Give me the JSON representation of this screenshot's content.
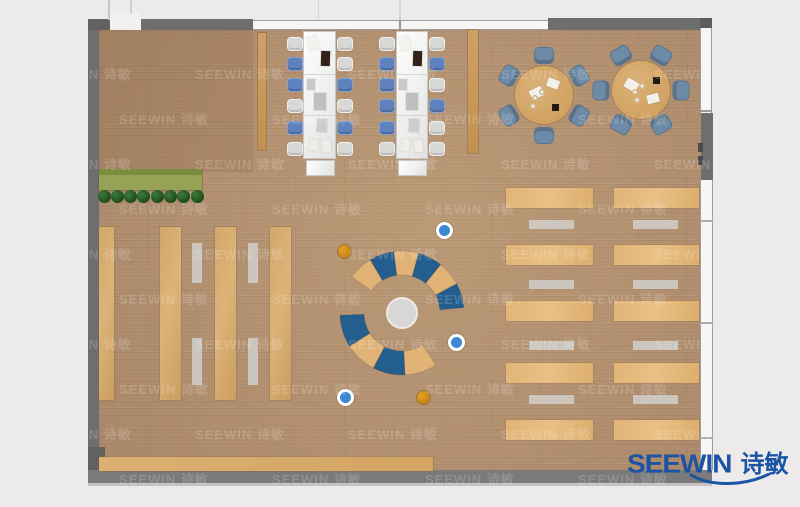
{
  "colors": {
    "outside": "#edebe9",
    "wall_dark": "#6e6e6e",
    "wall_bottom": "#7a7a7a",
    "floor_wood": "#b29070",
    "desk_tan": "#e0b273",
    "shelf_tan": "#d2a76a",
    "arc_blue": "#235e8f",
    "arc_tan": "#e2b377",
    "chair_blue": "#5d82bd",
    "chair_gray": "#d7d8d6",
    "round_chair_slate": "#6d8ba6",
    "stool_orange": "#cf8c15",
    "stool_blue": "#3d87d3",
    "logo_blue": "#1b53a6"
  },
  "logo": {
    "brand": "SEEWIN",
    "cjk": "诗敏",
    "color": "#1b53a6"
  },
  "watermark": {
    "text": "SEEWIN 诗敏",
    "opacity": 0.17,
    "font_size": 13,
    "area": {
      "x": 82,
      "y": 16,
      "w": 634,
      "h": 468
    },
    "row0": 48,
    "row_step": 45,
    "row_count": 10,
    "col0": -40,
    "col_step": 153,
    "odd_row_offset": 77
  },
  "room": {
    "floor": {
      "x": 99,
      "y": 29,
      "w": 602,
      "h": 442
    },
    "lounge_patch": {
      "x": 99,
      "y": 29,
      "w": 154,
      "h": 143,
      "color": "rgba(96,64,32,0.12)"
    }
  },
  "walls": [
    {
      "name": "wall-left",
      "x": 88,
      "y": 19,
      "w": 11,
      "h": 448,
      "color": "#6e6e6e"
    },
    {
      "name": "wall-top-left-corner",
      "x": 88,
      "y": 19,
      "w": 22,
      "h": 11,
      "color": "#626262"
    },
    {
      "name": "wall-top-segment-left",
      "x": 141,
      "y": 19,
      "w": 112,
      "h": 11,
      "color": "#6e6e6e"
    },
    {
      "name": "wall-top-segment-right",
      "x": 548,
      "y": 18,
      "w": 164,
      "h": 12,
      "color": "#6e6e6e"
    },
    {
      "name": "wall-top-right-cap",
      "x": 700,
      "y": 18,
      "w": 12,
      "h": 12,
      "color": "#5d5d5d"
    },
    {
      "name": "wall-right-solid",
      "x": 701,
      "y": 113,
      "w": 12,
      "h": 67,
      "color": "#6e6e6e"
    },
    {
      "name": "wall-bottom",
      "x": 88,
      "y": 470,
      "w": 624,
      "h": 13,
      "color": "#7a7a7a"
    },
    {
      "name": "wall-bottom-left-corner",
      "x": 88,
      "y": 447,
      "w": 17,
      "h": 23,
      "color": "#616161"
    }
  ],
  "windows": [
    {
      "name": "window-top",
      "x": 253,
      "y": 20,
      "w": 295,
      "h": 10,
      "orient": "h"
    },
    {
      "name": "window-right-upper",
      "x": 700,
      "y": 28,
      "w": 12,
      "h": 85,
      "orient": "v"
    },
    {
      "name": "window-right-lower",
      "x": 700,
      "y": 180,
      "w": 13,
      "h": 290,
      "orient": "v"
    },
    {
      "name": "door-opening-top",
      "x": 110,
      "y": 13,
      "w": 31,
      "h": 17,
      "orient": "open"
    }
  ],
  "lines": [
    {
      "name": "ceiling-line-1",
      "x": 108,
      "y": 0,
      "w": 2,
      "h": 20,
      "color": "#c7c5c2"
    },
    {
      "name": "ceiling-line-2",
      "x": 130,
      "y": 0,
      "w": 2,
      "h": 14,
      "color": "#d2d0cd"
    },
    {
      "name": "ceiling-line-3",
      "x": 318,
      "y": 0,
      "w": 1,
      "h": 20,
      "color": "#d8d6d3"
    },
    {
      "name": "window-mullion-upper",
      "x": 399,
      "y": 0,
      "w": 2,
      "h": 20,
      "color": "#d8d6d3"
    },
    {
      "name": "window-mullion",
      "x": 399,
      "y": 20,
      "w": 2,
      "h": 10,
      "color": "#9a9a9a"
    },
    {
      "name": "right-wall-tick-1",
      "x": 700,
      "y": 110,
      "w": 12,
      "h": 2,
      "color": "#9a9a9a"
    },
    {
      "name": "right-wall-tick-2",
      "x": 700,
      "y": 220,
      "w": 13,
      "h": 2,
      "color": "#ababab"
    },
    {
      "name": "right-wall-tick-3",
      "x": 700,
      "y": 322,
      "w": 13,
      "h": 2,
      "color": "#ababab"
    },
    {
      "name": "right-wall-tick-4",
      "x": 700,
      "y": 437,
      "w": 13,
      "h": 2,
      "color": "#ababab"
    },
    {
      "name": "right-door-handle-1",
      "x": 698,
      "y": 143,
      "w": 5,
      "h": 9,
      "color": "#4a4a4a"
    },
    {
      "name": "right-door-handle-2",
      "x": 698,
      "y": 156,
      "w": 5,
      "h": 9,
      "color": "#4a4a4a"
    },
    {
      "name": "bottom-wall-shadow",
      "x": 88,
      "y": 483,
      "w": 624,
      "h": 3,
      "color": "#c5c3c0"
    }
  ],
  "dividers": [
    {
      "name": "screen-divider-1",
      "x": 258,
      "y": 33,
      "w": 8,
      "h": 117
    },
    {
      "name": "screen-divider-2",
      "x": 468,
      "y": 30,
      "w": 10,
      "h": 123
    }
  ],
  "planter": {
    "body": {
      "x": 99,
      "y": 170,
      "w": 103,
      "h": 20
    },
    "top": {
      "x": 99,
      "y": 169,
      "w": 103,
      "h": 6
    },
    "tree_count": 8,
    "tree_x0": 104,
    "tree_step": 13.3,
    "tree_cy": 196,
    "tree_r": 6.5
  },
  "shelves": [
    {
      "name": "bookshelf-1",
      "x": 99,
      "y": 227,
      "w": 15,
      "h": 173
    },
    {
      "name": "bookshelf-2",
      "x": 160,
      "y": 227,
      "w": 21,
      "h": 173
    },
    {
      "name": "bookshelf-3",
      "x": 215,
      "y": 227,
      "w": 21,
      "h": 173
    },
    {
      "name": "bookshelf-4",
      "x": 270,
      "y": 227,
      "w": 21,
      "h": 173
    }
  ],
  "shelf_benches": [
    {
      "x": 192,
      "y": 243,
      "w": 10,
      "h": 40
    },
    {
      "x": 192,
      "y": 338,
      "w": 10,
      "h": 47
    },
    {
      "x": 248,
      "y": 243,
      "w": 10,
      "h": 40
    },
    {
      "x": 248,
      "y": 338,
      "w": 10,
      "h": 47
    }
  ],
  "reading_columns": [
    {
      "desk_x": 506,
      "desk_w": 87,
      "bench_x": 529,
      "bench_w": 45,
      "desk_ys": [
        188,
        245,
        301,
        363,
        420
      ],
      "desk_h": 20,
      "bench_ys": [
        220,
        280,
        341,
        395
      ],
      "bench_h": 9
    },
    {
      "desk_x": 614,
      "desk_w": 85,
      "bench_x": 633,
      "bench_w": 45,
      "desk_ys": [
        188,
        245,
        301,
        363,
        420
      ],
      "desk_h": 20,
      "bench_ys": [
        220,
        280,
        341,
        395
      ],
      "bench_h": 9
    }
  ],
  "bottom_counter": {
    "x": 99,
    "y": 457,
    "w": 334,
    "h": 14
  },
  "bench_desks": [
    {
      "desk": {
        "x": 303,
        "y": 31,
        "w": 33,
        "h": 128
      },
      "seams": [
        74,
        115
      ],
      "cap": {
        "x": 306,
        "y": 160,
        "w": 29,
        "h": 16
      },
      "chair_ys": [
        44,
        64,
        85,
        106,
        128,
        149
      ],
      "left_x": 287,
      "right_x": 337,
      "left_colors": [
        "gray",
        "blue",
        "blue",
        "gray",
        "blue",
        "gray"
      ],
      "right_colors": [
        "gray",
        "gray",
        "blue",
        "gray",
        "blue",
        "gray"
      ],
      "items": [
        {
          "x": 308,
          "y": 36,
          "w": 10,
          "h": 14,
          "color": "#f4f2ec",
          "rot": -14
        },
        {
          "x": 321,
          "y": 51,
          "w": 9,
          "h": 15,
          "color": "#33221a",
          "rot": 2
        },
        {
          "x": 307,
          "y": 79,
          "w": 8,
          "h": 11,
          "color": "#c9c9c7",
          "rot": 0
        },
        {
          "x": 314,
          "y": 93,
          "w": 12,
          "h": 17,
          "color": "#bfbfbd",
          "rot": 0
        },
        {
          "x": 317,
          "y": 119,
          "w": 10,
          "h": 13,
          "color": "#cdcdcb",
          "rot": 3
        },
        {
          "x": 309,
          "y": 139,
          "w": 9,
          "h": 12,
          "color": "#efede7",
          "rot": 10
        },
        {
          "x": 322,
          "y": 140,
          "w": 9,
          "h": 12,
          "color": "#efede7",
          "rot": -8
        }
      ]
    },
    {
      "desk": {
        "x": 396,
        "y": 31,
        "w": 32,
        "h": 128
      },
      "seams": [
        74,
        115
      ],
      "cap": {
        "x": 398,
        "y": 160,
        "w": 29,
        "h": 16
      },
      "chair_ys": [
        44,
        64,
        85,
        106,
        128,
        149
      ],
      "left_x": 379,
      "right_x": 429,
      "left_colors": [
        "gray",
        "blue",
        "blue",
        "blue",
        "blue",
        "gray"
      ],
      "right_colors": [
        "gray",
        "blue",
        "gray",
        "blue",
        "gray",
        "gray"
      ],
      "items": [
        {
          "x": 400,
          "y": 36,
          "w": 10,
          "h": 14,
          "color": "#f4f2ec",
          "rot": -14
        },
        {
          "x": 413,
          "y": 51,
          "w": 9,
          "h": 15,
          "color": "#33221a",
          "rot": 2
        },
        {
          "x": 399,
          "y": 79,
          "w": 8,
          "h": 11,
          "color": "#c9c9c7",
          "rot": 0
        },
        {
          "x": 406,
          "y": 93,
          "w": 12,
          "h": 17,
          "color": "#bfbfbd",
          "rot": 0
        },
        {
          "x": 409,
          "y": 119,
          "w": 10,
          "h": 13,
          "color": "#cdcdcb",
          "rot": 3
        },
        {
          "x": 401,
          "y": 139,
          "w": 9,
          "h": 12,
          "color": "#efede7",
          "rot": 10
        },
        {
          "x": 414,
          "y": 140,
          "w": 9,
          "h": 12,
          "color": "#efede7",
          "rot": -8
        }
      ]
    }
  ],
  "round_tables": [
    {
      "cx": 544,
      "cy": 95,
      "r": 29,
      "chair_dist": 40,
      "chair_angles": [
        -90,
        -150,
        150,
        90,
        30,
        -30
      ],
      "papers": [
        {
          "dx": -14,
          "dy": -7,
          "w": 13,
          "h": 10,
          "rot": -25
        },
        {
          "dx": 3,
          "dy": -16,
          "w": 12,
          "h": 9,
          "rot": 20
        }
      ],
      "cups": [
        {
          "dx": -9,
          "dy": 3
        },
        {
          "dx": -2,
          "dy": -3
        },
        {
          "dx": -11,
          "dy": 11
        }
      ],
      "dark": {
        "dx": 8,
        "dy": 9,
        "w": 7,
        "h": 7
      }
    },
    {
      "cx": 641,
      "cy": 90,
      "r": 29,
      "chair_dist": 40,
      "chair_angles": [
        0,
        -60,
        -120,
        180,
        120,
        60
      ],
      "papers": [
        {
          "dx": -16,
          "dy": -10,
          "w": 13,
          "h": 10,
          "rot": 30
        },
        {
          "dx": 6,
          "dy": 4,
          "w": 12,
          "h": 9,
          "rot": -15
        }
      ],
      "cups": [
        {
          "dx": -6,
          "dy": 2
        },
        {
          "dx": 1,
          "dy": -4
        },
        {
          "dx": -4,
          "dy": 10
        }
      ],
      "dark": {
        "dx": 12,
        "dy": -13,
        "w": 7,
        "h": 7
      }
    }
  ],
  "circle_lounge": {
    "cx": 402,
    "cy": 313,
    "center_r": 16,
    "ring_inner": 38,
    "ring_outer": 62,
    "arcs": [
      {
        "start": -144,
        "end": -5,
        "segments": [
          "tan",
          "blue",
          "tan",
          "blue",
          "tan",
          "blue"
        ]
      },
      {
        "start": 57,
        "end": 178,
        "segments": [
          "tan",
          "blue",
          "tan",
          "blue"
        ]
      }
    ]
  },
  "stools": [
    {
      "x": 344,
      "y": 251,
      "type": "orange"
    },
    {
      "x": 423,
      "y": 397,
      "type": "orange"
    },
    {
      "x": 444,
      "y": 230,
      "type": "blue"
    },
    {
      "x": 456,
      "y": 342,
      "type": "blue"
    },
    {
      "x": 345,
      "y": 397,
      "type": "blue"
    }
  ]
}
